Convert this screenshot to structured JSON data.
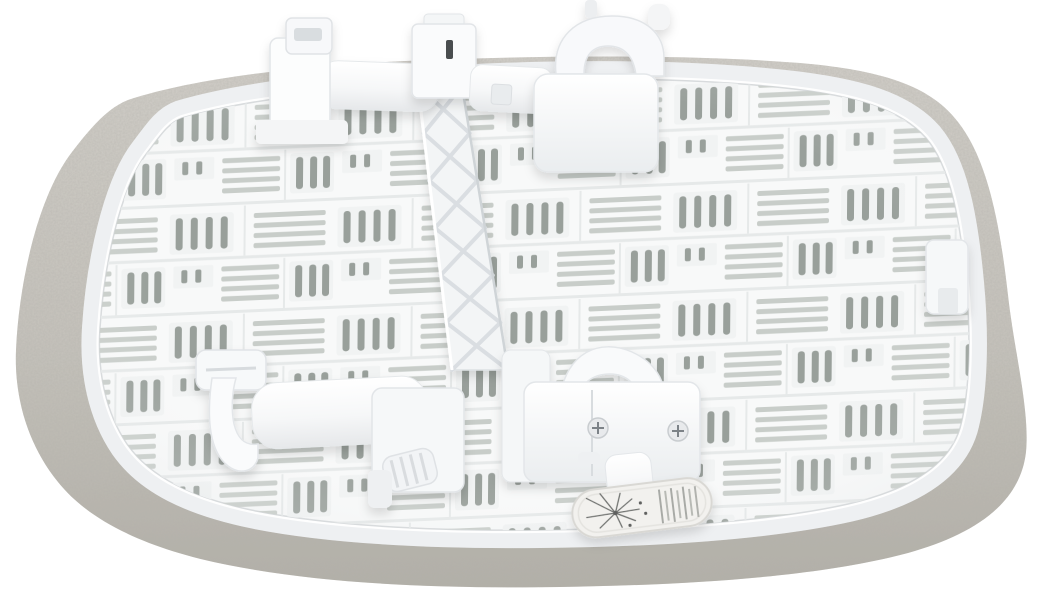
{
  "meta": {
    "type": "product-photograph",
    "description": "Studio photo on a plain white background showing the underside of a white plastic ventilated base panel (bedside crib / bassinet top) edged with a grey melange fabric rim and a white mesh trim. Two white plastic clamp mechanisms with hooks, sliders and a ridged knob sit on the panel, joined by a diagonal reinforcement rail with X-shaped ribs. A small oval care label with a starburst illustration and illegible fine print hangs near the bottom centre."
  },
  "scene": {
    "background_color": "#ffffff",
    "colors": {
      "background": "#ffffff",
      "plastic_white": "#fcfdfd",
      "plastic_mid": "#f4f5f6",
      "plastic_shadow": "#e2e5e8",
      "slot_dark": "#99a09b",
      "slot_light": "#c8cdc9",
      "rib_shadow": "#e6e9e9",
      "recess": "#f1f3f3",
      "fabric_light": "#cfccc6",
      "fabric_dark": "#b7b4ac",
      "mesh_white": "#eff1f3",
      "label_bg": "#f2f1ee",
      "label_border": "#d9d8d4",
      "screw_gray": "#7c8287",
      "ink_gray": "#70726f",
      "dark_slot_accent": "#4a4d4f"
    },
    "parts": {
      "fabric_rim": "grey melange fabric border around the panel",
      "mesh_trim": "white mesh band sewn along the inner edge of the fabric rim",
      "base_panel": "white plastic base with moulded ventilation slots",
      "vent_slots": "alternating groups of horizontal slats and vertical slots",
      "truss_rail": "diagonal reinforcement rail with X-shaped ribs",
      "clamp_top_left": "clamp arm with hook and slider block",
      "clamp_top_right": "clamp housing with curved carry handle",
      "clamp_bottom_left": "clamp hook, sliding cylinder and ridged tightening knob",
      "clamp_bottom_center": "clamp housing with curved handle, two screws and support post",
      "right_edge_tab": "small plastic locking tab at right edge",
      "care_label": {
        "shape": "oval tag",
        "graphic": "radiating starburst illustration with small dots",
        "text": "illegible micro-print (not readable in photo)"
      }
    }
  }
}
